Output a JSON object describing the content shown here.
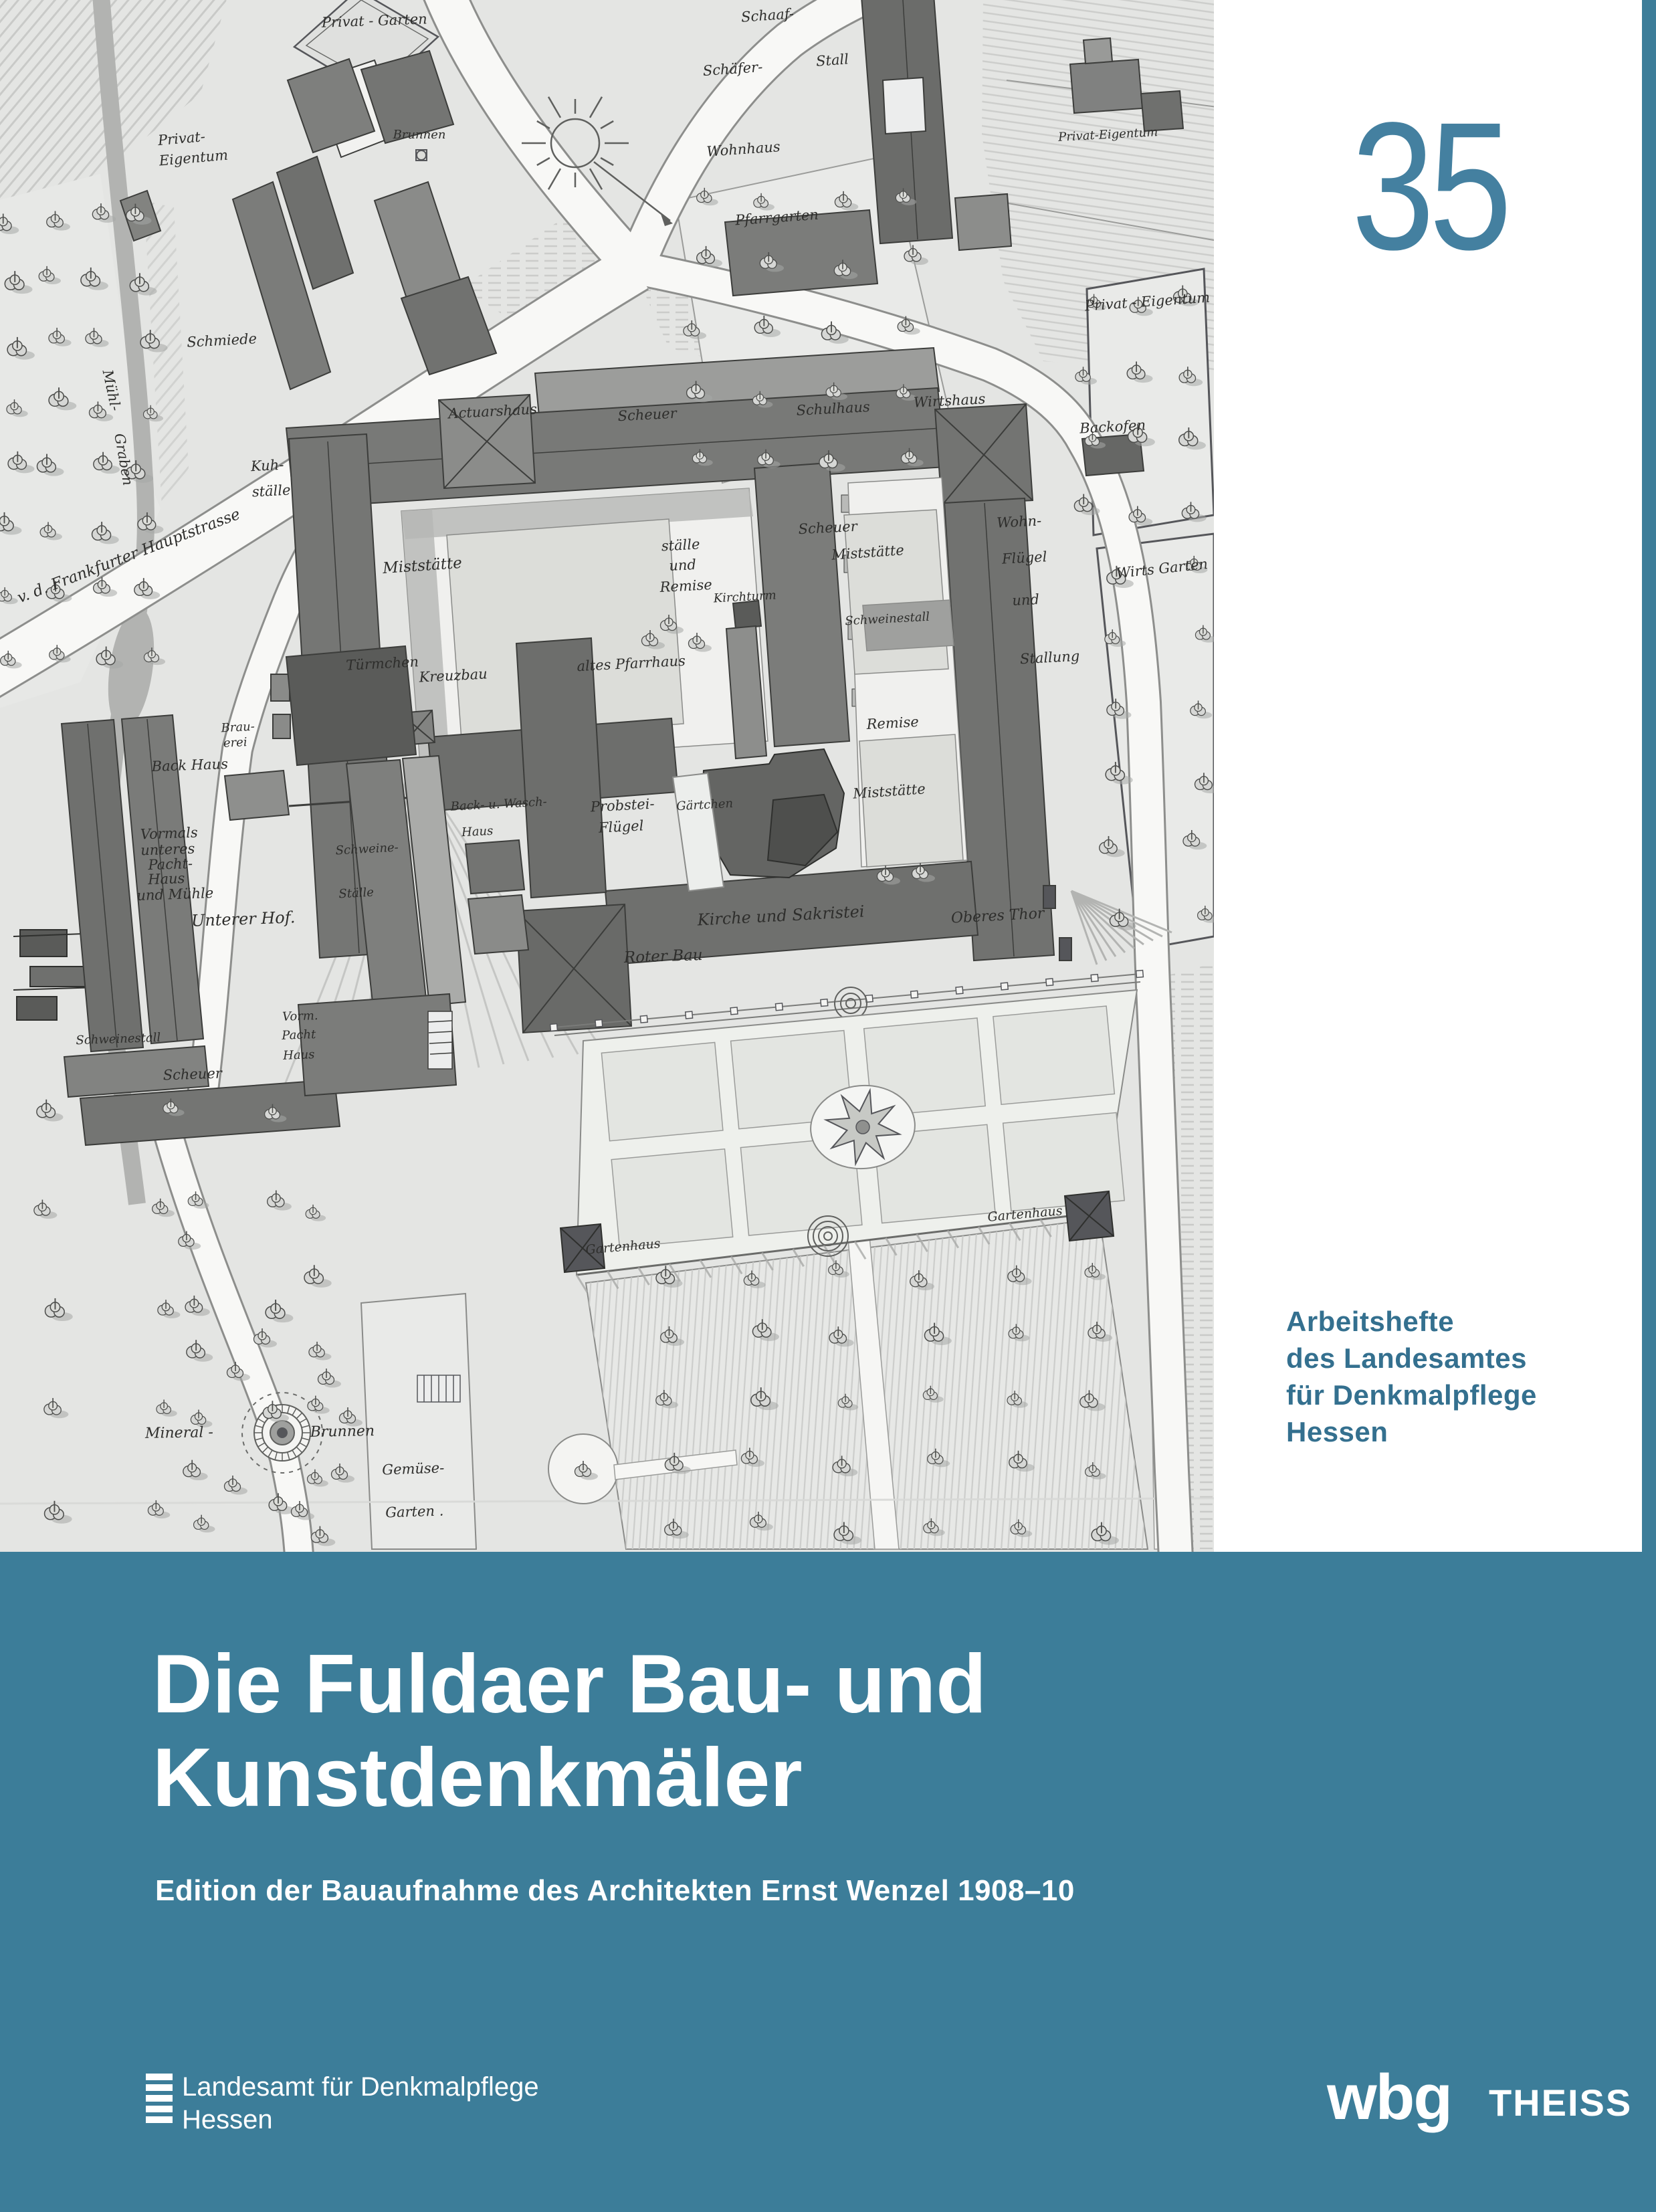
{
  "colors": {
    "teal_band": "#3C7D99",
    "issue_number": "#4480A0",
    "series_text": "#34708F"
  },
  "issue_number": "35",
  "series": {
    "line1": "Arbeitshefte",
    "line2": "des Landesamtes",
    "line3": "für Denkmalpflege",
    "line4": "Hessen"
  },
  "title": {
    "line1": "Die Fuldaer Bau- und",
    "line2": "Kunstdenkmäler"
  },
  "subtitle": "Edition der Bauaufnahme des Architekten Ernst Wenzel 1908–10",
  "publisher": {
    "name_line1": "Landesamt für Denkmalpflege",
    "name_line2": "Hessen",
    "imprint_wbg": "wbg",
    "imprint_theiss": "THEISS"
  },
  "map": {
    "labels": [
      {
        "text": "Privat - Garten",
        "x": 560,
        "y": 38,
        "r": -2
      },
      {
        "text": "Privat-",
        "x": 272,
        "y": 214,
        "r": -5
      },
      {
        "text": "Eigentum",
        "x": 290,
        "y": 243,
        "r": -5
      },
      {
        "text": "Schmiede",
        "x": 332,
        "y": 516,
        "r": -3
      },
      {
        "text": "Mühl-",
        "x": 160,
        "y": 585,
        "r": 78
      },
      {
        "text": "Graben",
        "x": 178,
        "y": 688,
        "r": 80
      },
      {
        "text": "v. d. Frankfurter  Hauptstrasse",
        "x": 195,
        "y": 838,
        "r": -21,
        "s": 23
      },
      {
        "text": "Brunnen",
        "x": 627,
        "y": 207,
        "r": 0,
        "s": 18
      },
      {
        "text": "Schaaf-",
        "x": 1148,
        "y": 30,
        "r": -4
      },
      {
        "text": "Schäfer-",
        "x": 1096,
        "y": 110,
        "r": -4
      },
      {
        "text": "Stall",
        "x": 1245,
        "y": 97,
        "r": -4
      },
      {
        "text": "Wohnhaus",
        "x": 1112,
        "y": 230,
        "r": -4
      },
      {
        "text": "Privat-Eigentum",
        "x": 1657,
        "y": 207,
        "r": -3,
        "s": 18
      },
      {
        "text": "Pfarrgarten",
        "x": 1162,
        "y": 332,
        "r": -4
      },
      {
        "text": "Privat - Eigentum",
        "x": 1716,
        "y": 458,
        "r": -4
      },
      {
        "text": "Backofen",
        "x": 1664,
        "y": 645,
        "r": -3
      },
      {
        "text": "Wirts Garten",
        "x": 1738,
        "y": 857,
        "r": -6
      },
      {
        "text": "Actuarshaus",
        "x": 737,
        "y": 622,
        "r": -3
      },
      {
        "text": "Scheuer",
        "x": 968,
        "y": 627,
        "r": -3
      },
      {
        "text": "Schulhaus",
        "x": 1246,
        "y": 618,
        "r": -3
      },
      {
        "text": "Wirtshaus",
        "x": 1420,
        "y": 606,
        "r": -3
      },
      {
        "text": "Kuh-",
        "x": 400,
        "y": 703,
        "r": -3
      },
      {
        "text": "ställe",
        "x": 406,
        "y": 741,
        "r": -3
      },
      {
        "text": "Miststätte",
        "x": 632,
        "y": 853,
        "r": -4,
        "s": 23
      },
      {
        "text": "ställe",
        "x": 1018,
        "y": 822,
        "r": -3
      },
      {
        "text": "und",
        "x": 1021,
        "y": 852,
        "r": -3
      },
      {
        "text": "Remise",
        "x": 1026,
        "y": 883,
        "r": -3
      },
      {
        "text": "Scheuer",
        "x": 1238,
        "y": 796,
        "r": -3
      },
      {
        "text": "Miststätte",
        "x": 1298,
        "y": 833,
        "r": -4
      },
      {
        "text": "Kirchturm",
        "x": 1114,
        "y": 898,
        "r": -3,
        "s": 18
      },
      {
        "text": "Schweinestall",
        "x": 1327,
        "y": 931,
        "r": -3,
        "s": 18
      },
      {
        "text": "Wohn-",
        "x": 1524,
        "y": 787,
        "r": -3
      },
      {
        "text": "Flügel",
        "x": 1532,
        "y": 841,
        "r": -3
      },
      {
        "text": "und",
        "x": 1534,
        "y": 904,
        "r": -3
      },
      {
        "text": "Stallung",
        "x": 1570,
        "y": 990,
        "r": -3
      },
      {
        "text": "Türmchen",
        "x": 572,
        "y": 999,
        "r": -3
      },
      {
        "text": "Kreuzbau",
        "x": 678,
        "y": 1017,
        "r": -3
      },
      {
        "text": "altes Pfarrhaus",
        "x": 944,
        "y": 999,
        "r": -3
      },
      {
        "text": "Remise",
        "x": 1335,
        "y": 1088,
        "r": -3
      },
      {
        "text": "Miststätte",
        "x": 1330,
        "y": 1190,
        "r": -4
      },
      {
        "text": "Brau-",
        "x": 356,
        "y": 1093,
        "r": -3,
        "s": 18
      },
      {
        "text": "erei",
        "x": 352,
        "y": 1116,
        "r": -3,
        "s": 18
      },
      {
        "text": "Back Haus",
        "x": 284,
        "y": 1151,
        "r": -2
      },
      {
        "text": "Back- u. Wasch-",
        "x": 746,
        "y": 1208,
        "r": -3,
        "s": 18
      },
      {
        "text": "Haus",
        "x": 714,
        "y": 1249,
        "r": -3,
        "s": 18
      },
      {
        "text": "Probstei-",
        "x": 931,
        "y": 1211,
        "r": -3
      },
      {
        "text": "Flügel",
        "x": 929,
        "y": 1243,
        "r": -3
      },
      {
        "text": "Gärtchen",
        "x": 1054,
        "y": 1209,
        "r": -3,
        "s": 18
      },
      {
        "text": "Schweine-",
        "x": 549,
        "y": 1275,
        "r": -3,
        "s": 18
      },
      {
        "text": "Ställe",
        "x": 533,
        "y": 1341,
        "r": -3,
        "s": 18
      },
      {
        "text": "Vormals",
        "x": 253,
        "y": 1253,
        "r": -2
      },
      {
        "text": "unteres",
        "x": 251,
        "y": 1277,
        "r": -2
      },
      {
        "text": "Pacht-",
        "x": 255,
        "y": 1299,
        "r": -2
      },
      {
        "text": "Haus",
        "x": 249,
        "y": 1321,
        "r": -2
      },
      {
        "text": "und Mühle",
        "x": 262,
        "y": 1344,
        "r": -2
      },
      {
        "text": "Unterer Hof.",
        "x": 364,
        "y": 1382,
        "r": -2,
        "s": 24
      },
      {
        "text": "Kirche und Sakristei",
        "x": 1168,
        "y": 1377,
        "r": -3,
        "s": 24
      },
      {
        "text": "Oberes Thor",
        "x": 1492,
        "y": 1376,
        "r": -3,
        "s": 22
      },
      {
        "text": "Roter Bau",
        "x": 992,
        "y": 1437,
        "r": -2,
        "s": 23
      },
      {
        "text": "Vorm.",
        "x": 449,
        "y": 1525,
        "r": -2,
        "s": 18
      },
      {
        "text": "Pacht",
        "x": 447,
        "y": 1553,
        "r": -2,
        "s": 18
      },
      {
        "text": "Haus",
        "x": 447,
        "y": 1583,
        "r": -2,
        "s": 18
      },
      {
        "text": "Schweinestall",
        "x": 177,
        "y": 1559,
        "r": -2,
        "s": 18
      },
      {
        "text": "Scheuer",
        "x": 288,
        "y": 1613,
        "r": -2
      },
      {
        "text": "Gartenhaus",
        "x": 932,
        "y": 1870,
        "r": -5,
        "s": 19
      },
      {
        "text": "Gartenhaus",
        "x": 1533,
        "y": 1821,
        "r": -5,
        "s": 19
      },
      {
        "text": "Mineral -",
        "x": 268,
        "y": 2149,
        "r": -1,
        "s": 22
      },
      {
        "text": "Brunnen",
        "x": 512,
        "y": 2147,
        "r": -1,
        "s": 22
      },
      {
        "text": "Gemüse-",
        "x": 618,
        "y": 2203,
        "r": -2,
        "s": 21
      },
      {
        "text": "Garten .",
        "x": 620,
        "y": 2267,
        "r": -2,
        "s": 21
      }
    ]
  }
}
